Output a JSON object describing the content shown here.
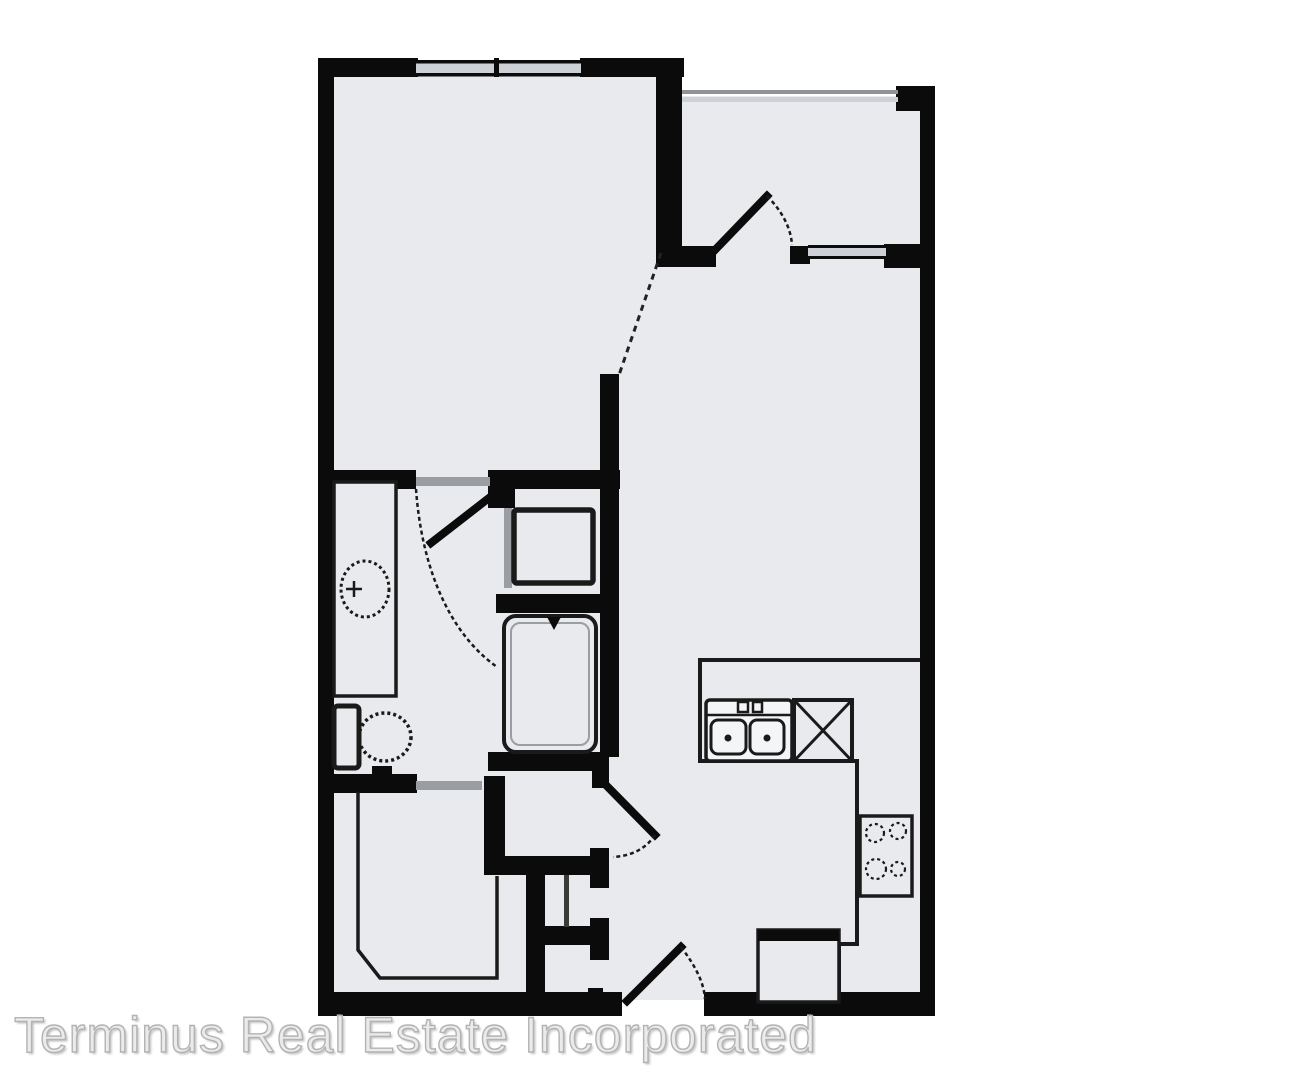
{
  "watermark": {
    "text": "Terminus Real Estate Incorporated"
  },
  "colors": {
    "floor": "#e8eaee",
    "wall": "#0b0b0b",
    "stroke": "#1a1a1a",
    "gray": "#9a9da1",
    "lightgray": "#cdd0d4",
    "watermark": "#ebebeb",
    "watermarkstroke": "#b3b3b3"
  },
  "icons": [
    "bedroom-window-icon",
    "balcony-railing-icon",
    "balcony-door-icon",
    "balcony-window-icon",
    "bedroom-bathroom-door-icon",
    "angled-opening-dashed-line-icon",
    "vanity-counter-icon",
    "vanity-sink-icon",
    "toilet-icon",
    "washer-icon",
    "bathtub-icon",
    "walk-in-closet-icon",
    "utility-closet-door-icon",
    "entry-door-icon",
    "kitchen-counter-icon",
    "kitchen-sink-icon",
    "dishwasher-icon",
    "stove-icon",
    "refrigerator-icon"
  ]
}
